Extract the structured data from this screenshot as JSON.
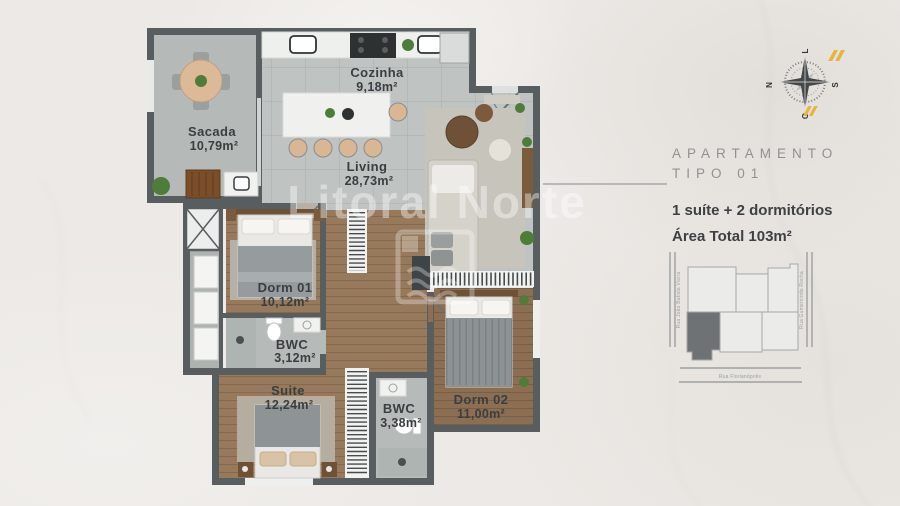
{
  "watermark": {
    "brand": "Litoral Norte"
  },
  "floor_plan": {
    "rooms": [
      {
        "name": "Sacada",
        "area": "10,79m²"
      },
      {
        "name": "Cozinha",
        "area": "9,18m²"
      },
      {
        "name": "Living",
        "area": "28,73m²"
      },
      {
        "name": "Dorm 01",
        "area": "10,12m²"
      },
      {
        "name": "BWC",
        "area": "3,12m²"
      },
      {
        "name": "Suite",
        "area": "12,24m²"
      },
      {
        "name": "BWC",
        "area": "3,38m²"
      },
      {
        "name": "Dorm 02",
        "area": "11,00m²"
      }
    ]
  },
  "info_panel": {
    "title_line1": "APARTAMENTO",
    "title_line2": "TIPO 01",
    "features": "1 suíte + 2 dormitórios",
    "total_area": "Área Total 103m²"
  },
  "compass": {
    "north": "N",
    "south": "S",
    "east_label": "L",
    "west_label": "O"
  },
  "site_map": {
    "street_left": "Rua João Batista Vieira",
    "street_right": "Rua Gumercindo Rocha",
    "street_bottom": "Rua Florianópolis"
  },
  "colors": {
    "background": "#ece9e6",
    "wall": "#585e60",
    "accent_yellow": "#e7b53c",
    "highlighted_unit": "#6e7275"
  }
}
